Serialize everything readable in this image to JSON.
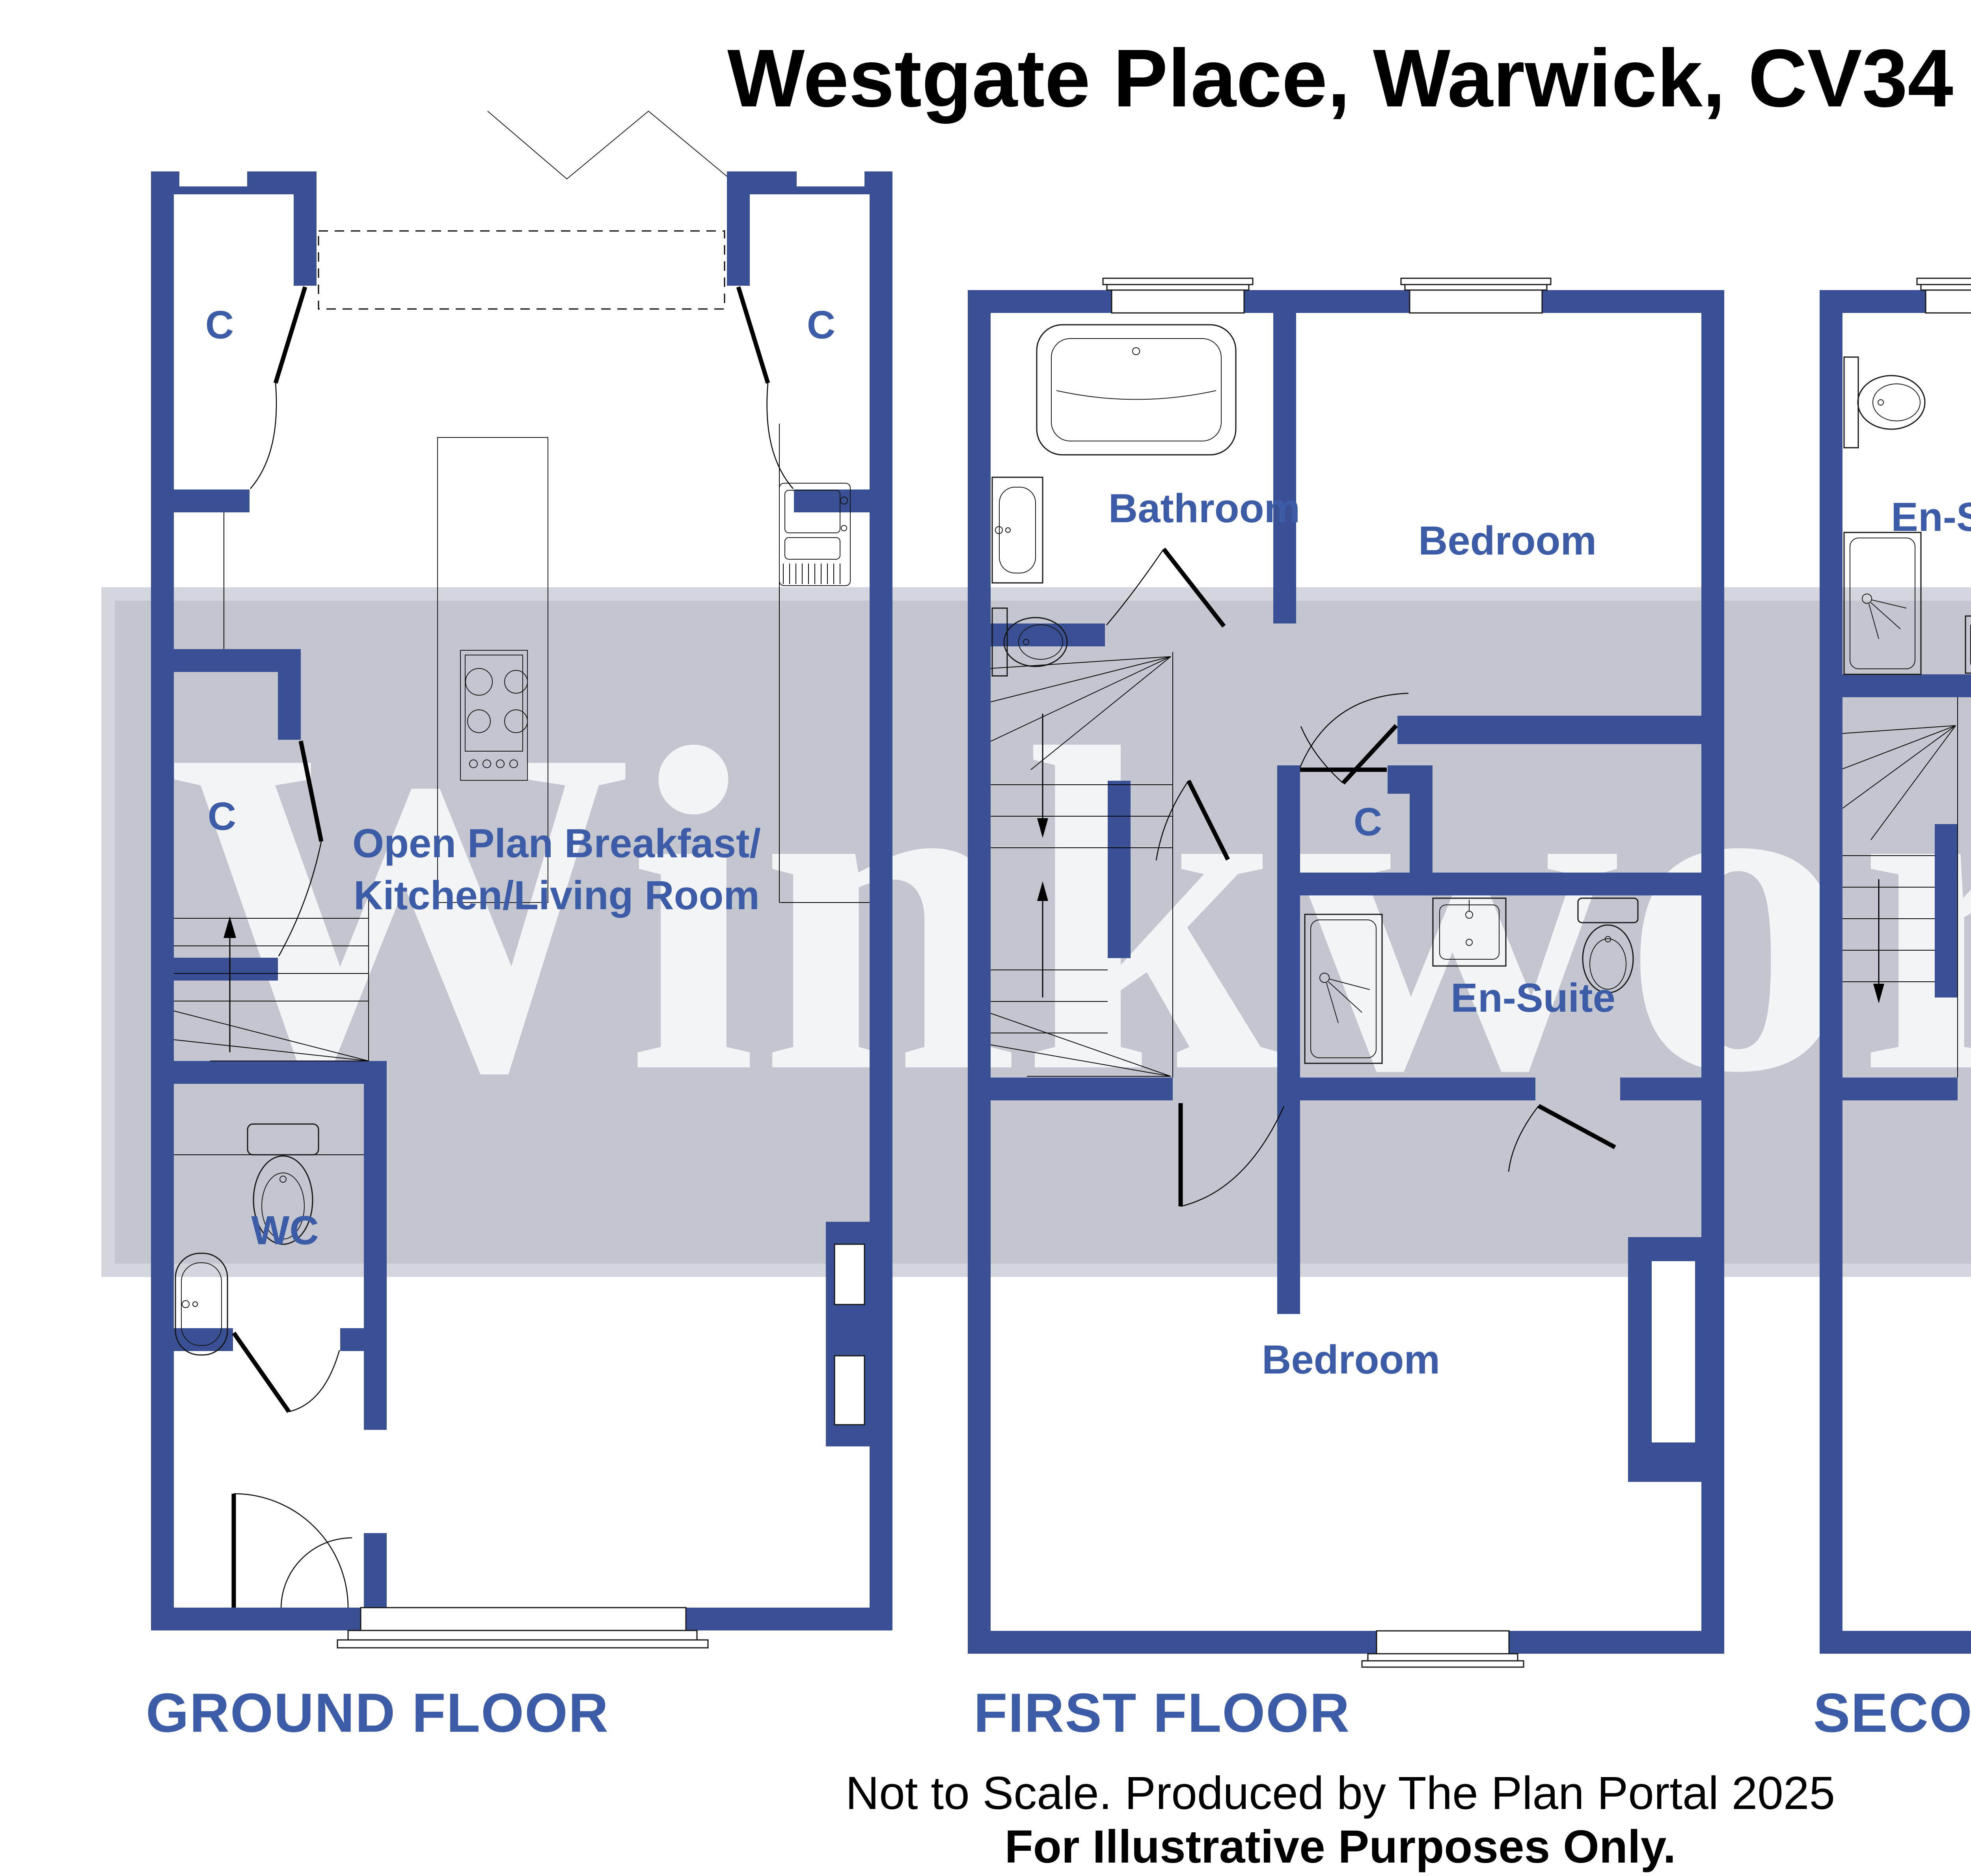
{
  "title": "Westgate Place, Warwick, CV34",
  "watermark": {
    "text": "Winkworth"
  },
  "colors": {
    "wall": "#3a5094",
    "label_blue": "#3d5ca8",
    "watermark_band": "#c3c5cf",
    "watermark_band_edge": "#d4d6de",
    "watermark_text": "rgba(255,255,255,0.8)"
  },
  "floors": [
    {
      "name": "GROUND FLOOR",
      "labels": [
        "C",
        "C",
        "C",
        "Open Plan Breakfast/",
        "Kitchen/Living Room",
        "WC"
      ]
    },
    {
      "name": "FIRST FLOOR",
      "labels": [
        "Bathroom",
        "Bedroom",
        "C",
        "En-Suite",
        "Bedroom"
      ]
    },
    {
      "name": "SECOND FLOOR",
      "labels": [
        "En-Suite",
        "Bedroom",
        "C",
        "En-Suite",
        "Bedroom"
      ]
    }
  ],
  "footer": {
    "line1": "Not to Scale. Produced by The Plan Portal 2025",
    "line2": "For Illustrative Purposes Only."
  }
}
